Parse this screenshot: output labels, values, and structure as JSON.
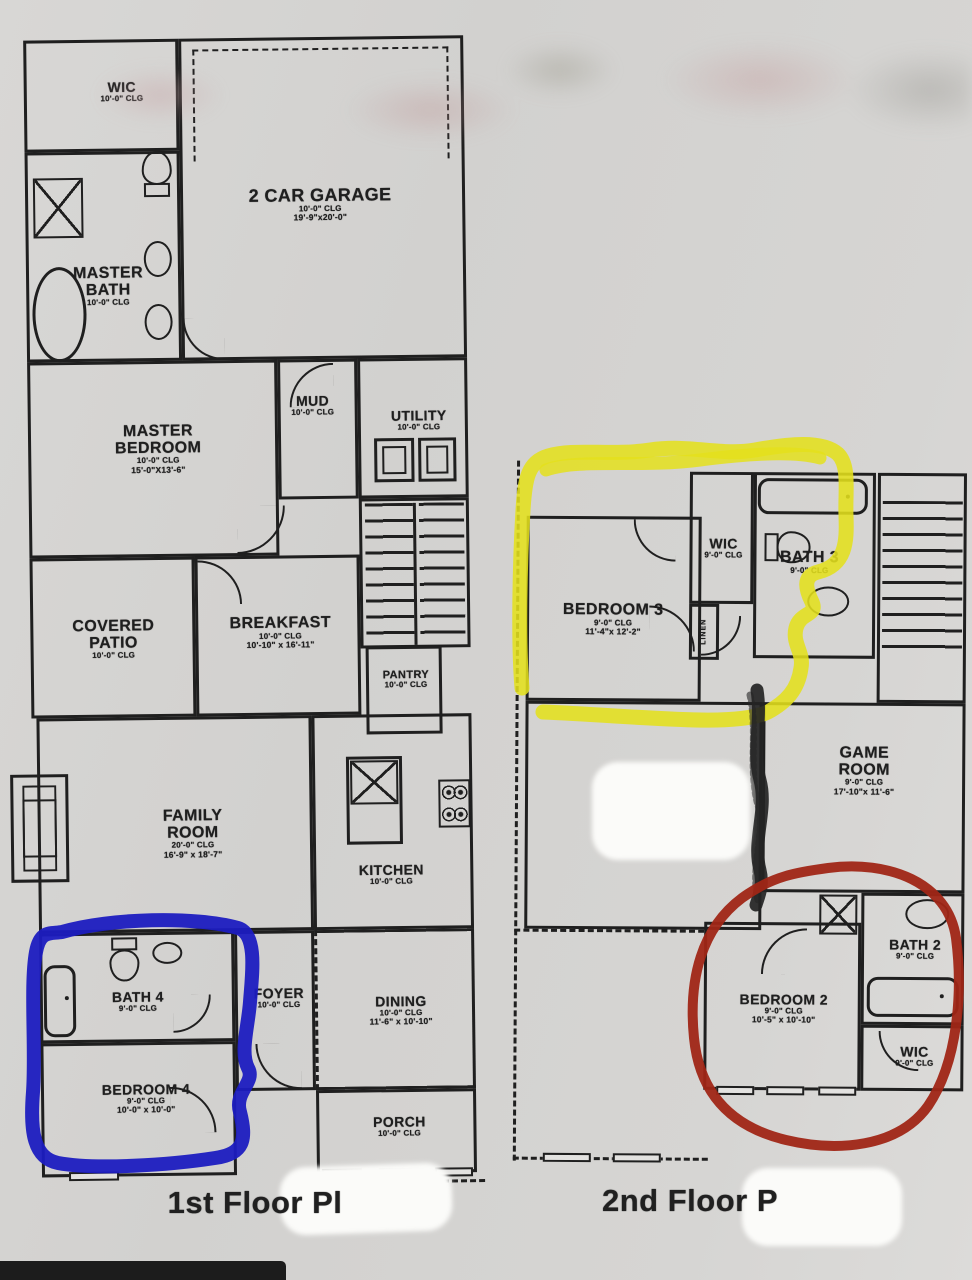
{
  "page": {
    "floor1_label": "1st Floor Pl",
    "floor2_label": "2nd Floor P"
  },
  "f1": {
    "wic": {
      "name": "WIC",
      "clg": "10'-0\" CLG"
    },
    "master_bath": {
      "name": "MASTER\nBATH",
      "clg": "10'-0\" CLG"
    },
    "garage": {
      "name": "2 CAR GARAGE",
      "clg": "10'-0\" CLG",
      "dims": "19'-9\"x20'-0\""
    },
    "master_bedroom": {
      "name": "MASTER\nBEDROOM",
      "clg": "10'-0\" CLG",
      "dims": "15'-0\"X13'-6\""
    },
    "mud": {
      "name": "MUD",
      "clg": "10'-0\" CLG"
    },
    "utility": {
      "name": "UTILITY",
      "clg": "10'-0\" CLG"
    },
    "covered_patio": {
      "name": "COVERED\nPATIO",
      "clg": "10'-0\" CLG"
    },
    "breakfast": {
      "name": "BREAKFAST",
      "clg": "10'-0\" CLG",
      "dims": "10'-10\" x 16'-11\""
    },
    "pantry": {
      "name": "PANTRY",
      "clg": "10'-0\" CLG"
    },
    "family_room": {
      "name": "FAMILY\nROOM",
      "clg": "20'-0\" CLG",
      "dims": "16'-9\" x 18'-7\""
    },
    "kitchen": {
      "name": "KITCHEN",
      "clg": "10'-0\" CLG"
    },
    "bath4": {
      "name": "BATH 4",
      "clg": "9'-0\" CLG"
    },
    "foyer": {
      "name": "FOYER",
      "clg": "10'-0\" CLG"
    },
    "dining": {
      "name": "DINING",
      "clg": "10'-0\" CLG",
      "dims": "11'-6\" x 10'-10\""
    },
    "bedroom4": {
      "name": "BEDROOM 4",
      "clg": "9'-0\" CLG",
      "dims": "10'-0\" x 10'-0\""
    },
    "porch": {
      "name": "PORCH",
      "clg": "10'-0\" CLG"
    }
  },
  "f2": {
    "bedroom3": {
      "name": "BEDROOM 3",
      "clg": "9'-0\" CLG",
      "dims": "11'-4\"x 12'-2\""
    },
    "wic3": {
      "name": "WIC",
      "clg": "9'-0\" CLG"
    },
    "bath3": {
      "name": "BATH 3",
      "clg": "9'-0\" CLG"
    },
    "linen": {
      "name": "LINEN"
    },
    "game_room": {
      "name": "GAME\nROOM",
      "clg": "9'-0\" CLG",
      "dims": "17'-10\"x 11'-6\""
    },
    "bedroom2": {
      "name": "BEDROOM 2",
      "clg": "9'-0\" CLG",
      "dims": "10'-5\" x 10'-10\""
    },
    "bath2": {
      "name": "BATH 2",
      "clg": "9'-0\" CLG"
    },
    "wic2": {
      "name": "WIC",
      "clg": "9'-0\" CLG"
    }
  },
  "annotations": {
    "blue_hex": "#1c1cc0",
    "yellow_hex": "#e4e01c",
    "red_hex": "#a02616",
    "scribble_hex": "#242424"
  }
}
